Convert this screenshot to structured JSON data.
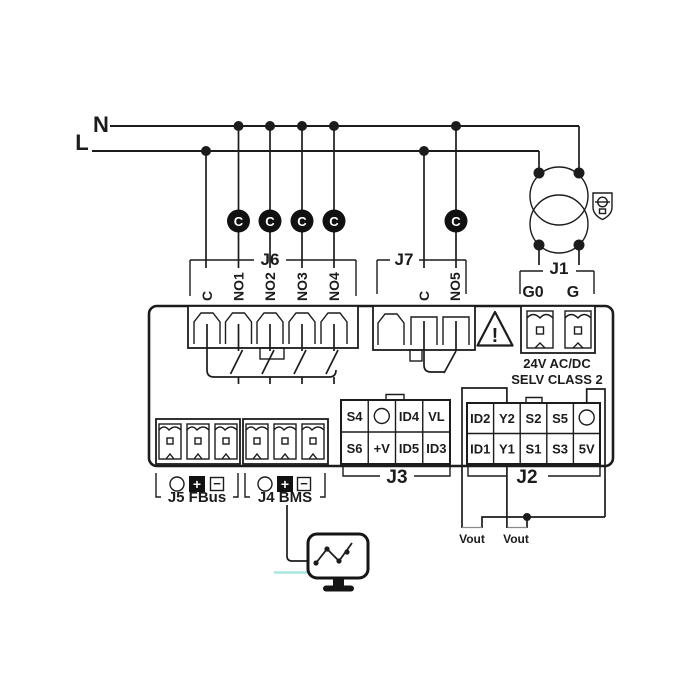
{
  "diagram": {
    "power": {
      "neutral_label": "N",
      "line_label": "L"
    },
    "fuse": {
      "label": "C"
    },
    "j6": {
      "label": "J6",
      "terminals": [
        "C",
        "NO1",
        "NO2",
        "NO3",
        "NO4"
      ]
    },
    "j7": {
      "label": "J7",
      "terminals": [
        "C",
        "NO5"
      ]
    },
    "j1": {
      "label": "J1",
      "terminals": [
        "G0",
        "G"
      ],
      "caption1": "24V AC/DC",
      "caption2": "SELV CLASS 2"
    },
    "warning": {
      "symbol": "!"
    },
    "j3": {
      "label": "J3",
      "row1": [
        "S4",
        "ID4",
        "VL"
      ],
      "row2": [
        "S6",
        "+V",
        "ID5",
        "ID3"
      ]
    },
    "j2": {
      "label": "J2",
      "row1": [
        "ID2",
        "Y2",
        "S2",
        "S5"
      ],
      "row2": [
        "ID1",
        "Y1",
        "S1",
        "S3",
        "5V"
      ]
    },
    "j5": {
      "label": "J5 FBus",
      "plus": "+",
      "minus": "−"
    },
    "j4": {
      "label": "J4 BMS",
      "plus": "+",
      "minus": "−"
    },
    "vout": {
      "label": "Vout"
    },
    "colors": {
      "ink": "#1c1c1c",
      "accent_line": "#a9e6e2"
    }
  }
}
